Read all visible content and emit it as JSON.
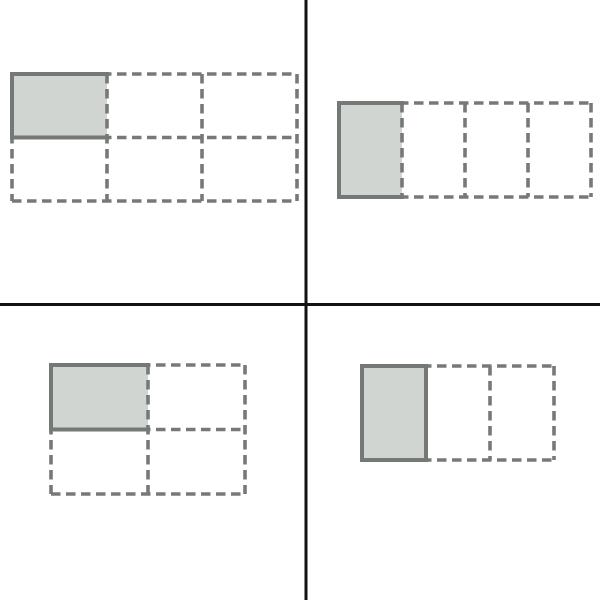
{
  "figure": {
    "type": "fraction-area-models",
    "background": "#ffffff",
    "colors": {
      "divider": "#121212",
      "grid_line": "#767a76",
      "shaded_fill": "#d1d5d1",
      "shaded_border": "#757975"
    },
    "style": {
      "dash_width": 3.6,
      "solid_width": 4,
      "dash_array": "9.5 5.5"
    },
    "dividers": {
      "vertical_x": 306,
      "horizontal_y": 304.5,
      "thickness": 3
    },
    "panels": [
      {
        "name": "top-left-grid",
        "model": "one-sixth shaded: 3 columns x 2 rows, top-left cell shaded",
        "cols": 3,
        "rows": 2,
        "origin": [
          12,
          74
        ],
        "cell_size": [
          95,
          63.5
        ],
        "shaded_cell": [
          0,
          0
        ],
        "solid_edges": [
          "top",
          "left",
          "bottom"
        ]
      },
      {
        "name": "top-right-grid",
        "model": "one-fourth shaded: 4 columns x 1 row, first cell shaded",
        "cols": 4,
        "rows": 1,
        "origin": [
          339,
          103
        ],
        "cell_size": [
          63,
          94
        ],
        "shaded_cell": [
          0,
          0
        ],
        "solid_edges": [
          "top",
          "left",
          "bottom"
        ]
      },
      {
        "name": "bottom-left-grid",
        "model": "one-fourth shaded: 2 columns x 2 rows, top-left cell shaded",
        "cols": 2,
        "rows": 2,
        "origin": [
          51,
          365
        ],
        "cell_size": [
          97,
          64.5
        ],
        "shaded_cell": [
          0,
          0
        ],
        "solid_edges": [
          "top",
          "left",
          "bottom"
        ]
      },
      {
        "name": "bottom-right-grid",
        "model": "one-third shaded: 3 columns x 1 row, first cell shaded",
        "cols": 3,
        "rows": 1,
        "origin": [
          362,
          366
        ],
        "cell_size": [
          64,
          94
        ],
        "shaded_cell": [
          0,
          0
        ],
        "solid_edges": [
          "top",
          "left",
          "bottom",
          "right"
        ]
      }
    ]
  }
}
